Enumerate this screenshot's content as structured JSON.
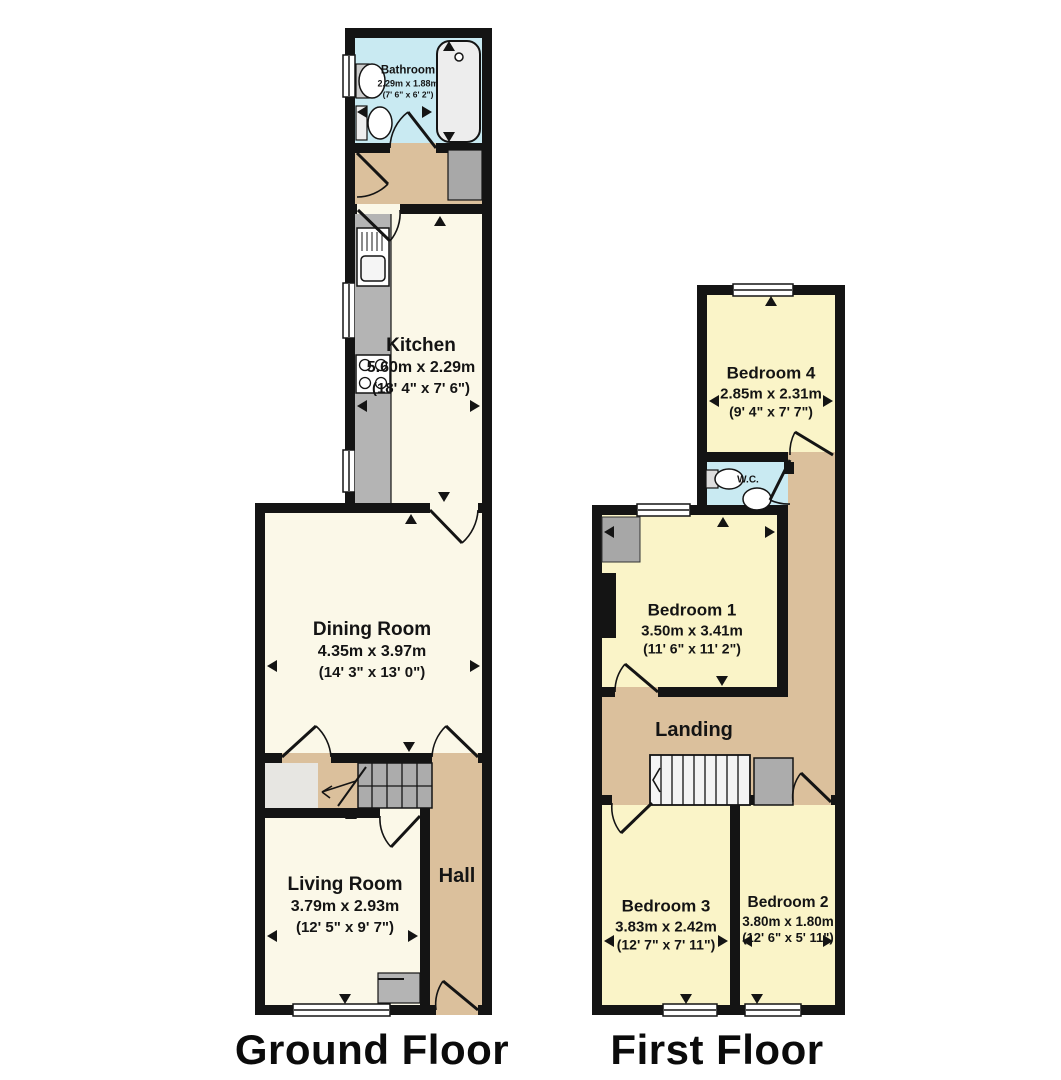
{
  "plan": {
    "ground_title": "Ground Floor",
    "first_title": "First Floor"
  },
  "rooms": {
    "bathroom": {
      "name": "Bathroom",
      "metric": "2.29m x 1.88m",
      "imperial": "(7' 6\" x 6' 2\")"
    },
    "kitchen": {
      "name": "Kitchen",
      "metric": "5.60m x 2.29m",
      "imperial": "(18' 4\" x 7' 6\")"
    },
    "dining": {
      "name": "Dining Room",
      "metric": "4.35m x 3.97m",
      "imperial": "(14' 3\" x 13' 0\")"
    },
    "living": {
      "name": "Living Room",
      "metric": "3.79m x 2.93m",
      "imperial": "(12' 5\" x 9' 7\")"
    },
    "hall": {
      "name": "Hall"
    },
    "bedroom4": {
      "name": "Bedroom 4",
      "metric": "2.85m x 2.31m",
      "imperial": "(9' 4\" x 7' 7\")"
    },
    "wc": {
      "name": "W.C."
    },
    "bedroom1": {
      "name": "Bedroom 1",
      "metric": "3.50m x 3.41m",
      "imperial": "(11' 6\" x 11' 2\")"
    },
    "landing": {
      "name": "Landing"
    },
    "bedroom3": {
      "name": "Bedroom 3",
      "metric": "3.83m x 2.42m",
      "imperial": "(12' 7\" x 7' 11\")"
    },
    "bedroom2": {
      "name": "Bedroom 2",
      "metric": "3.80m x 1.80m",
      "imperial": "(12' 6\" x 5' 11\")"
    }
  },
  "colors": {
    "wall": "#141414",
    "floor_cream": "#FBF8E8",
    "floor_yellow": "#FAF4C8",
    "floor_blue": "#C9EAF2",
    "floor_tan": "#DBC09C",
    "appliance_gray": "#B4B4B4",
    "stair_gray": "#ACACAC",
    "fixture_white": "#FFFFFF"
  }
}
